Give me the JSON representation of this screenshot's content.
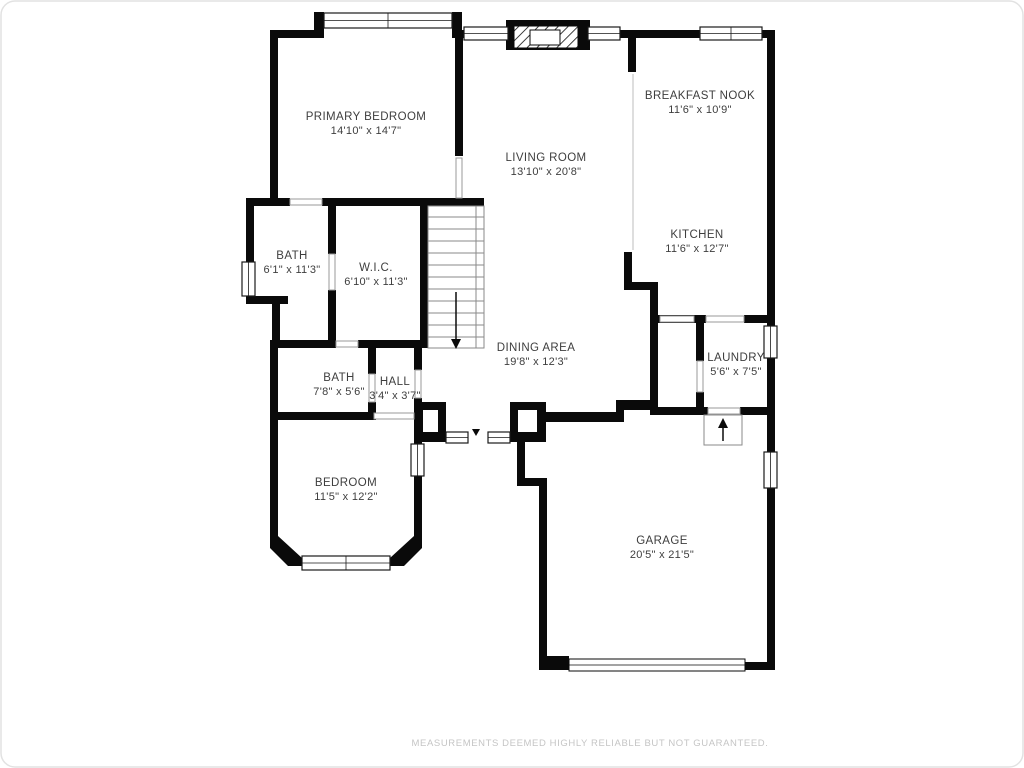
{
  "rooms": {
    "primary_bedroom": {
      "name": "PRIMARY BEDROOM",
      "dims": "14'10\" x 14'7\""
    },
    "living_room": {
      "name": "LIVING ROOM",
      "dims": "13'10\" x 20'8\""
    },
    "breakfast_nook": {
      "name": "BREAKFAST NOOK",
      "dims": "11'6\" x 10'9\""
    },
    "kitchen": {
      "name": "KITCHEN",
      "dims": "11'6\" x 12'7\""
    },
    "bath_primary": {
      "name": "BATH",
      "dims": "6'1\" x 11'3\""
    },
    "wic": {
      "name": "W.I.C.",
      "dims": "6'10\" x 11'3\""
    },
    "bath_hall": {
      "name": "BATH",
      "dims": "7'8\" x 5'6\""
    },
    "hall": {
      "name": "HALL",
      "dims": "3'4\" x 3'7\""
    },
    "bedroom": {
      "name": "BEDROOM",
      "dims": "11'5\" x 12'2\""
    },
    "dining_area": {
      "name": "DINING AREA",
      "dims": "19'8\" x 12'3\""
    },
    "laundry": {
      "name": "LAUNDRY",
      "dims": "5'6\" x 7'5\""
    },
    "garage": {
      "name": "GARAGE",
      "dims": "20'5\" x 21'5\""
    }
  },
  "footer": {
    "disclaimer": "MEASUREMENTS DEEMED HIGHLY RELIABLE BUT NOT GUARANTEED."
  },
  "colors": {
    "wall": "#0a0a0a",
    "label_text": "#3e3e3e",
    "footer_text": "#c5c5c5"
  }
}
